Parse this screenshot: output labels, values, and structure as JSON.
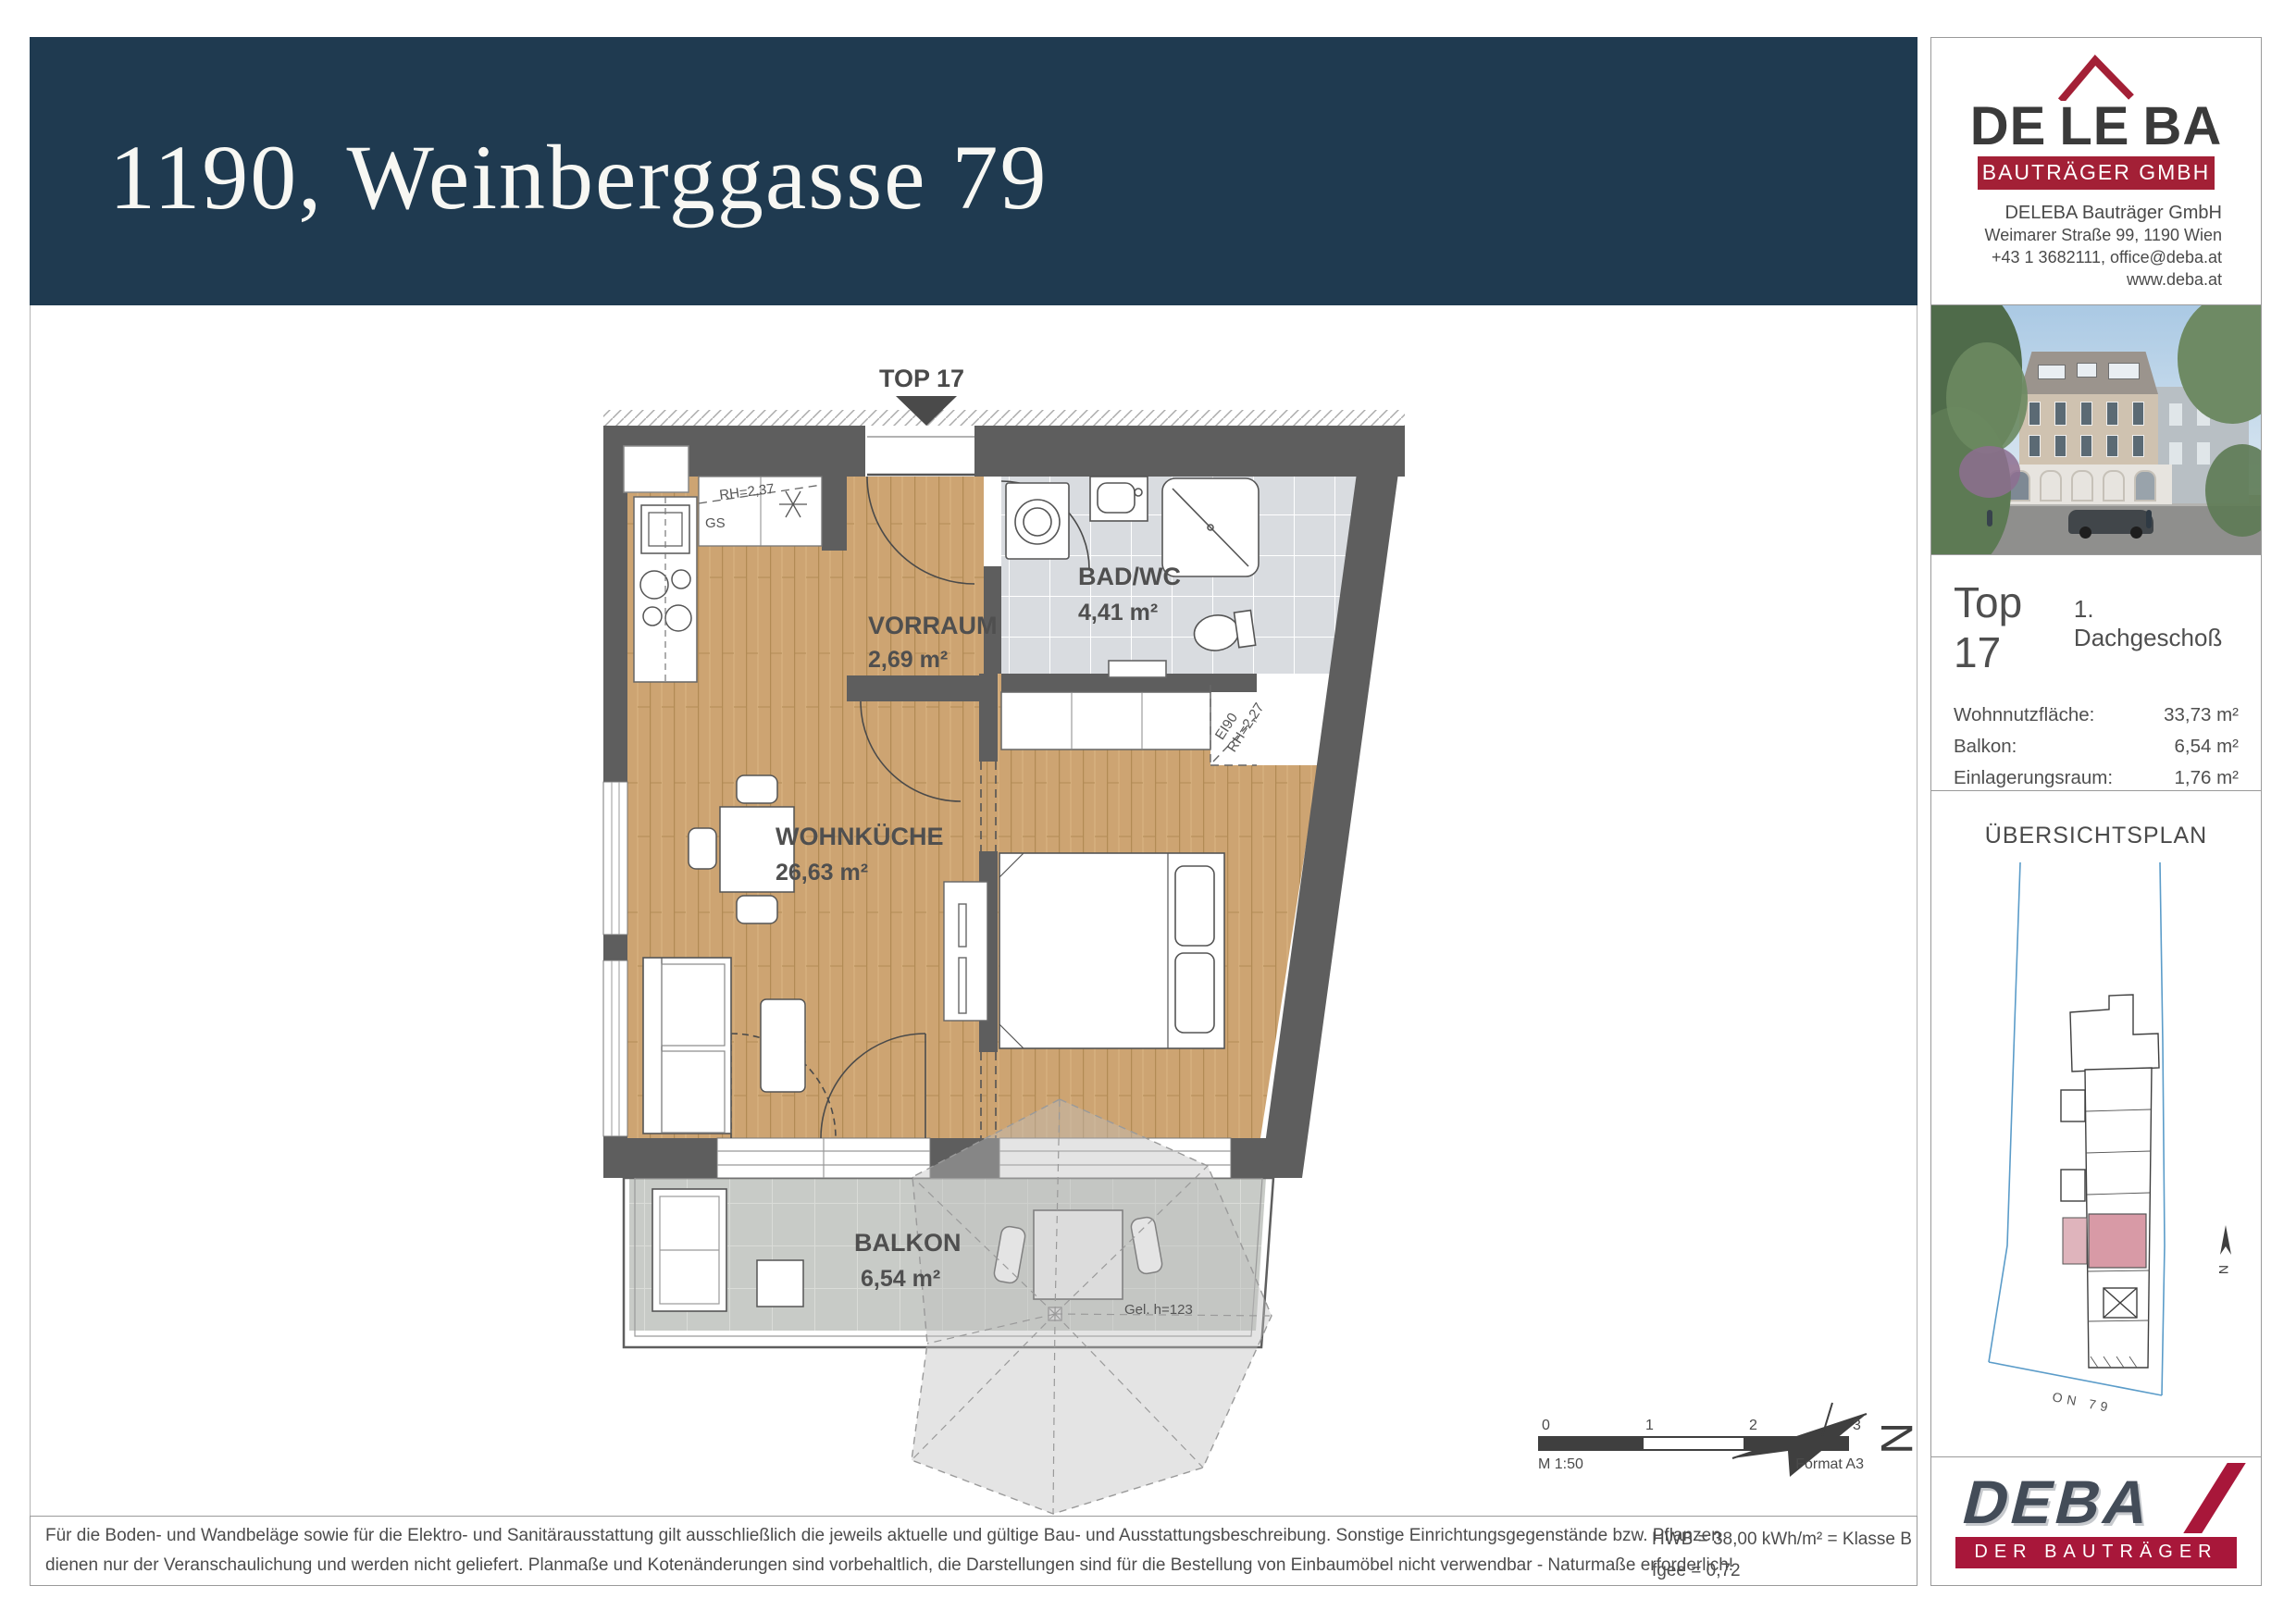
{
  "header": {
    "title": "1190, Weinberggasse 79"
  },
  "brand": {
    "segments": [
      "DE",
      "LE",
      "BA"
    ],
    "banner": "BAUTRÄGER GMBH",
    "company": "DELEBA Bauträger GmbH",
    "address": "Weimarer Straße 99, 1190 Wien",
    "contact": "+43 1 3682111, office@deba.at",
    "website": "www.deba.at"
  },
  "unit": {
    "name": "Top 17",
    "floor": "1. Dachgeschoß",
    "rows": [
      {
        "label": "Wohnnutzfläche:",
        "value": "33,73 m²"
      },
      {
        "label": "Balkon:",
        "value": "6,54 m²"
      },
      {
        "label": "Einlagerungsraum:",
        "value": "1,76 m²"
      }
    ],
    "price_label": "Verkaufspreis:",
    "price_value": "€ 340.000,--"
  },
  "overview": {
    "title": "ÜBERSICHTSPLAN",
    "street_label": "ON 79",
    "north": "N"
  },
  "compass": {
    "label": "N"
  },
  "floorplan": {
    "top_label": "TOP 17",
    "rooms": [
      {
        "name": "VORRAUM",
        "area": "2,69 m²"
      },
      {
        "name": "BAD/WC",
        "area": "4,41 m²"
      },
      {
        "name": "WOHNKÜCHE",
        "area": "26,63 m²"
      },
      {
        "name": "BALKON",
        "area": "6,54 m²"
      }
    ],
    "annotations": {
      "gs": "GS",
      "rh_kitchen": "RH=2,37",
      "ei90": "EI90",
      "rh_slant": "RH=2,27",
      "gel": "Gel. h=123"
    }
  },
  "scalebar": {
    "ticks": [
      "0",
      "1",
      "2",
      "3"
    ],
    "scale_label": "M 1:50",
    "format_label": "Format A3"
  },
  "energy": {
    "line1": "HWB = 38,00 kWh/m² = Klasse B",
    "line2": "fgee = 0,72"
  },
  "footer": {
    "disclaimer1": "Für die Boden- und Wandbeläge sowie für die Elektro- und Sanitärausstattung gilt ausschließlich die jeweils aktuelle und gültige Bau- und Ausstattungsbeschreibung. Sonstige Einrichtungsgegenstände bzw. Pflanzen",
    "disclaimer2": "dienen nur der Veranschaulichung und werden nicht geliefert. Planmaße und Kotenänderungen sind vorbehaltlich, die Darstellungen sind für die Bestellung von Einbaumöbel nicht verwendbar - Naturmaße erforderlich!"
  },
  "deba": {
    "text": "DEBA",
    "banner": "DER BAUTRÄGER"
  },
  "colors": {
    "header_blue": "#1F3A50",
    "brand_red": "#A32036",
    "wall_gray": "#5E5E5E",
    "wood": "#CDA472",
    "bath_tile": "#D9DCE0",
    "balcony_tile": "#C8CBC7",
    "highlight_pink": "#D89AA6"
  }
}
